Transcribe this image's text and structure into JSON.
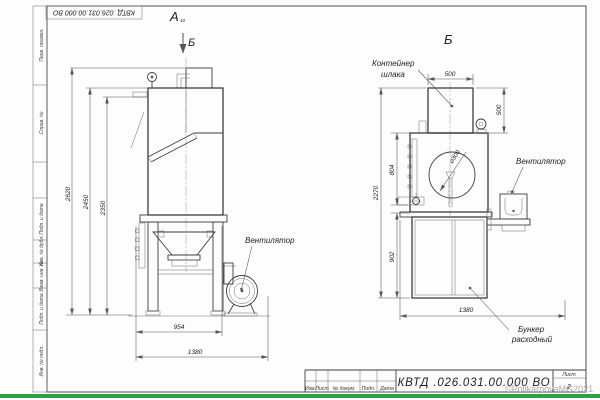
{
  "frame": {
    "stamp_top": "КВТД .026.031.00.000  ВО",
    "side_fields": [
      "Перв. примен.",
      "Справ. №",
      "Подп. и дата",
      "Инв. № дубл.",
      "Взам. инв. №",
      "Подп. и дата",
      "Инв. № подл."
    ]
  },
  "views": {
    "a": {
      "label": "А",
      "label_sub": "10",
      "arrow_label": "Б"
    },
    "b": {
      "label": "Б"
    }
  },
  "ann": {
    "fan_a": "Вентилятор",
    "fan_b": "Вентилятор",
    "container_line1": "Контейнер",
    "container_line2": "шлака",
    "hopper_line1": "Бункер",
    "hopper_line2": "расходный",
    "diameter": "⌀300"
  },
  "dims": {
    "a": {
      "h_overall": "2620",
      "h_body": "2450",
      "h_inner": "2350",
      "w_body": "954",
      "w_overall": "1380"
    },
    "b": {
      "w_container": "500",
      "h_container": "500",
      "h_overall": "2270",
      "h_upper": "804",
      "h_lower": "902",
      "w_overall": "1380"
    }
  },
  "title_block": {
    "designation": "КВТД .026.031.00.000  ВО",
    "columns": [
      "Изм.",
      "Лист",
      "№ докум.",
      "Подп.",
      "Дата"
    ],
    "sheet_label": "Лист",
    "sheet_number": "2"
  },
  "watermark": {
    "text": "©PolikarpovaMG2021"
  },
  "colors": {
    "footer_green": "#2f9e44",
    "watermark_gray": "#aaabad"
  }
}
